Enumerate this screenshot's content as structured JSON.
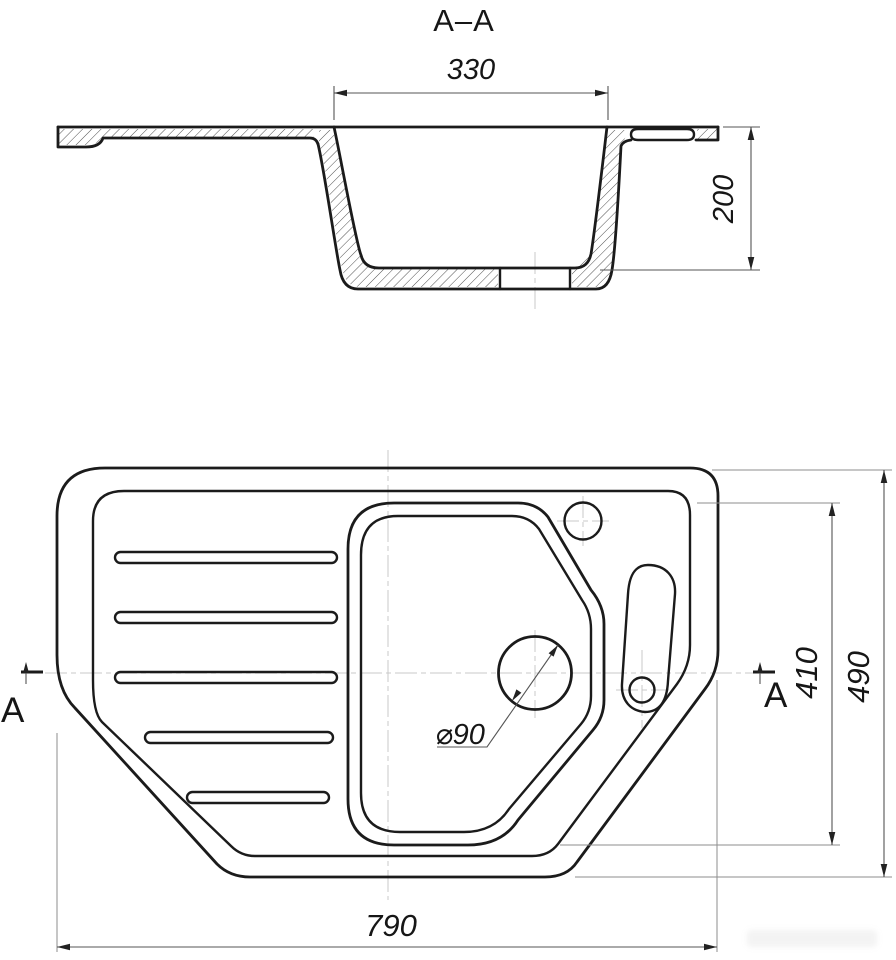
{
  "drawing": {
    "title": "A–A",
    "section_view": {
      "bowl_top_width_dim": "330",
      "bowl_depth_dim": "200"
    },
    "plan_view": {
      "overall_width_dim": "790",
      "overall_depth_dim": "490",
      "bowl_length_dim": "410",
      "drain_diameter_label": "⌀90",
      "section_marker_left": "A",
      "section_marker_right": "A"
    },
    "colors": {
      "outline": "#1b1b1b",
      "dimension_lines": "#555555",
      "extension_lines": "#8d8d8d",
      "centerlines": "#c9c9c9",
      "background": "#ffffff"
    }
  }
}
